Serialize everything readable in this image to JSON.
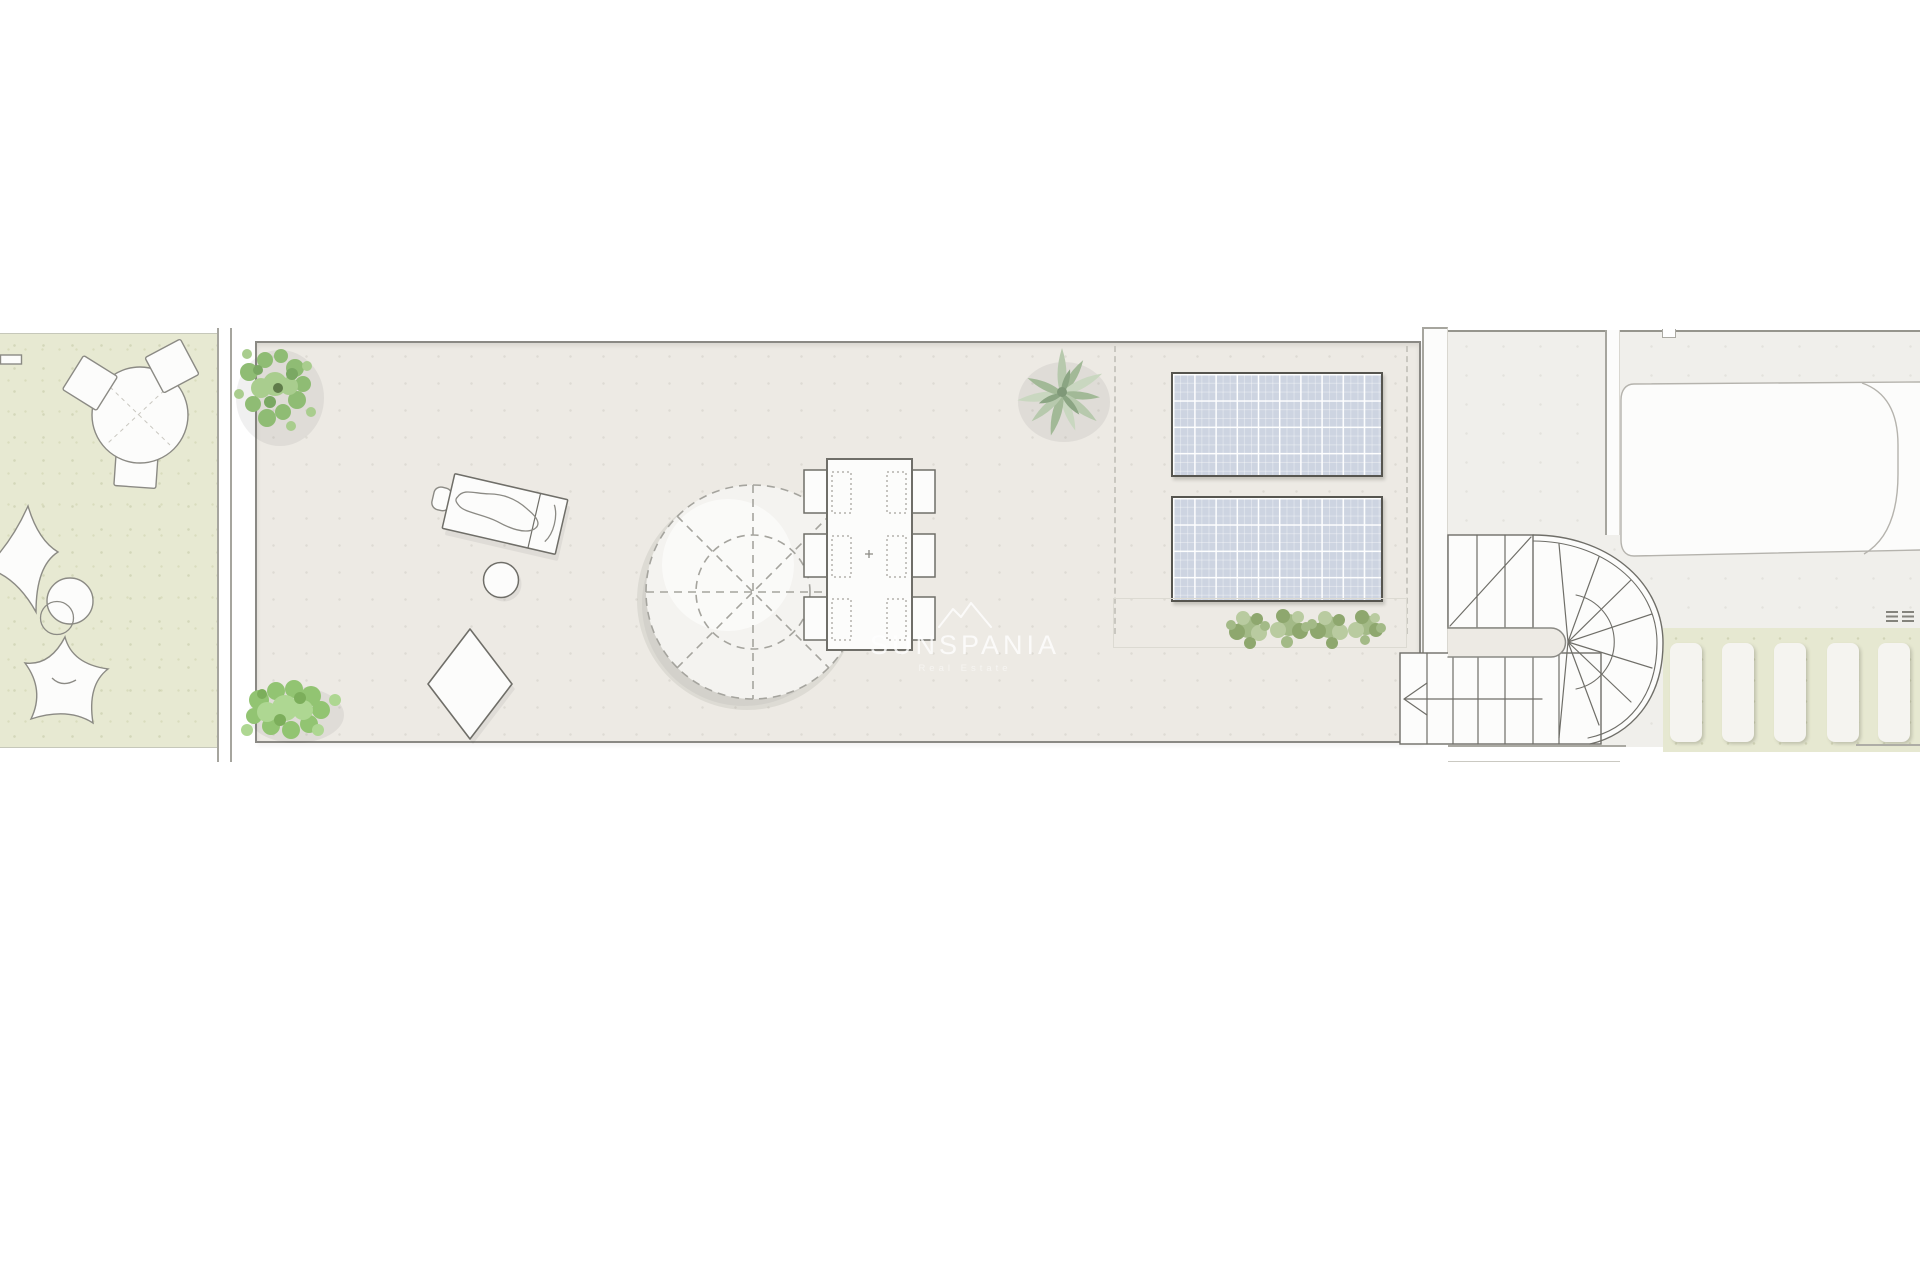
{
  "document": {
    "type": "architectural roof-terrace floor plan, top view",
    "page_background": "#ffffff"
  },
  "watermark": {
    "logo": "twin-mountain-outline",
    "brand": "SUNSPANIA",
    "tagline": "Real Estate"
  },
  "colors": {
    "paper": "#ffffff",
    "garden_fill": "#e7e9d2",
    "garden_edge": "#c6c8ba",
    "wall_line": "#a6a59e",
    "terrace_fill": "#edeae4",
    "terrace_border": "#8a8984",
    "roof_fill": "#f0efeb",
    "roof_edge": "#96958d",
    "white_fill": "#fcfcfb",
    "line_dark": "#6f6e68",
    "line_mid": "#8b8a84",
    "dash_line": "#c9c7c0",
    "panel_fill": "#cdd4e1",
    "panel_border": "#56554f",
    "pergola_fill": "#e6e8d1",
    "slat_fill": "#f5f4f0",
    "pool_line": "#b5b3ad",
    "watermark_white": "#ffffff"
  },
  "garden_area": {
    "round_table": 1,
    "chairs": 3,
    "bean_bag_cushions": 2,
    "pouf_circles": 2
  },
  "terrace_area": {
    "sun_lounger": 1,
    "side_table": 1,
    "floor_cushion": 1,
    "parasol": 1,
    "dining_table": 1,
    "dining_chairs": 6,
    "corner_bushes": 2,
    "agave_plant": 1,
    "shrub_row_count": 4,
    "solar_panels": {
      "count": 2,
      "grid_cols": 10,
      "grid_rows": 4
    }
  },
  "right_roof_area": {
    "pool": 1,
    "u_shaped_staircase": {
      "upper_treads": 3,
      "lower_treads": 6,
      "radial_treads": 8
    },
    "pergola_slats": 5,
    "vent_hatch_marks": 6
  }
}
